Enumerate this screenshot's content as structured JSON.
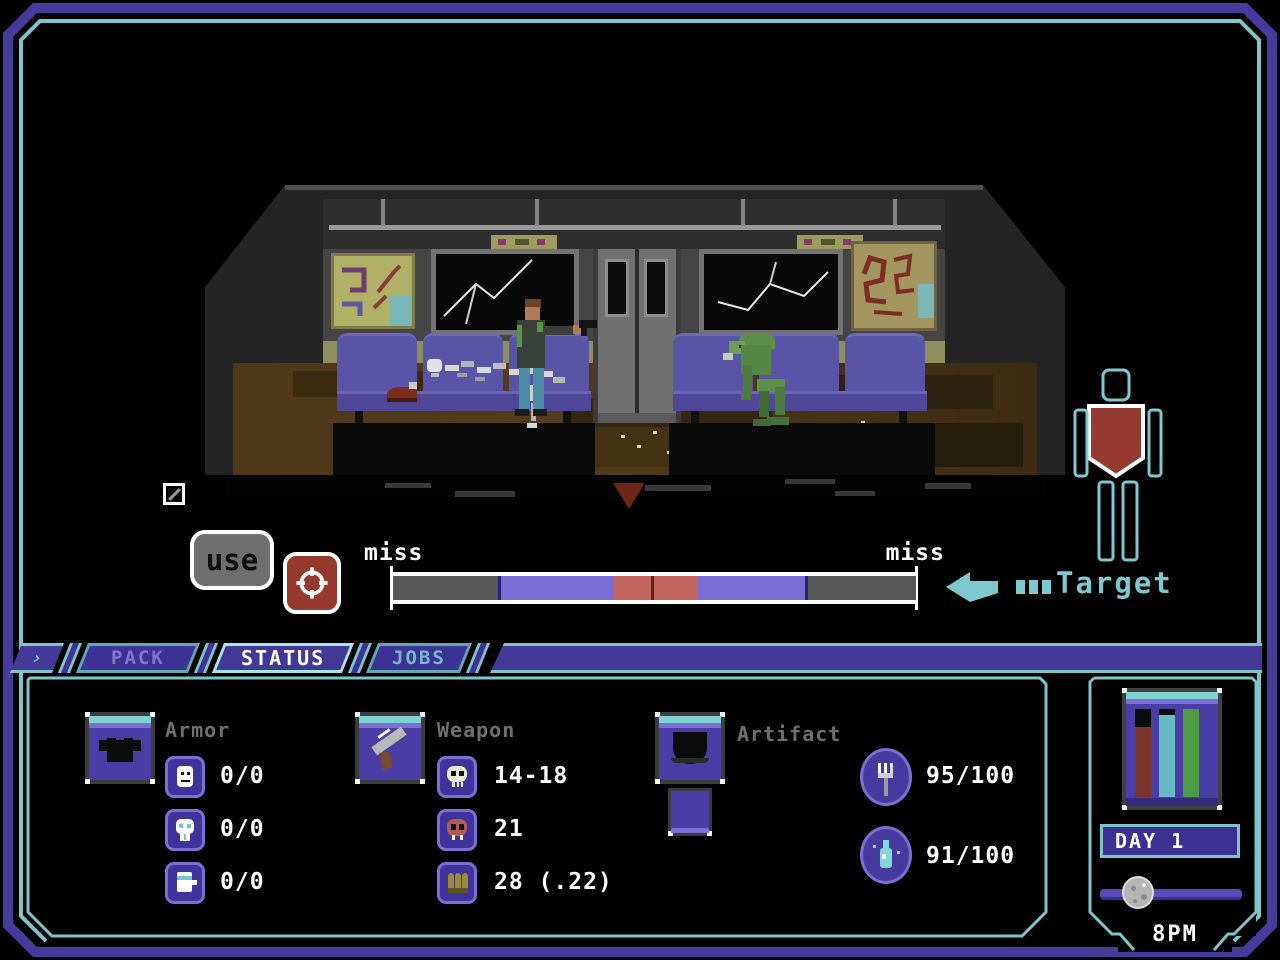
{
  "combat_hud": {
    "use_button_label": "use",
    "reticle_icon": "crosshair-icon",
    "miss_left": "miss",
    "miss_right": "miss",
    "target_label": "Target",
    "bar_segments": [
      {
        "color": "#585858",
        "width": 20.0
      },
      {
        "color": "#2a2270",
        "width": 0.6
      },
      {
        "color": "#7b6ed6",
        "width": 21.4
      },
      {
        "color": "#c4645e",
        "width": 7.4
      },
      {
        "color": "#5e1f1f",
        "width": 0.6
      },
      {
        "color": "#c4645e",
        "width": 8.2
      },
      {
        "color": "#7b6ed6",
        "width": 20.6
      },
      {
        "color": "#2a2270",
        "width": 0.6
      },
      {
        "color": "#585858",
        "width": 20.6
      }
    ]
  },
  "tabs": [
    {
      "label": "PACK",
      "active": false
    },
    {
      "label": "STATUS",
      "active": true
    },
    {
      "label": "JOBS",
      "active": false
    }
  ],
  "status_panel": {
    "armor": {
      "label": "Armor",
      "rows": [
        {
          "icon": "head-armor-icon",
          "value": "0/0"
        },
        {
          "icon": "mask-armor-icon",
          "value": "0/0"
        },
        {
          "icon": "torso-armor-icon",
          "value": "0/0"
        }
      ]
    },
    "weapon": {
      "label": "Weapon",
      "rows": [
        {
          "icon": "skull-icon",
          "value": "14-18"
        },
        {
          "icon": "red-skull-icon",
          "value": "21"
        },
        {
          "icon": "bullets-icon",
          "value": "28 (.22)"
        }
      ]
    },
    "artifact": {
      "label": "Artifact"
    },
    "needs": [
      {
        "icon": "fork-icon",
        "value": "95/100"
      },
      {
        "icon": "bottle-icon",
        "value": "91/100"
      }
    ]
  },
  "side_panel": {
    "day_label": "DAY 1",
    "time_label": "8PM",
    "vitals": [
      {
        "name": "vital-red",
        "color": "#7c352b",
        "fill_pct": 80
      },
      {
        "name": "vital-teal",
        "color": "#66b9c9",
        "fill_pct": 93
      },
      {
        "name": "vital-green",
        "color": "#4d9c44",
        "fill_pct": 100
      }
    ]
  },
  "colors": {
    "frame_purple": "#473b9b",
    "frame_teal": "#7fc4c8",
    "hud_teal": "#7ec9cf",
    "target_red": "#943a31"
  }
}
